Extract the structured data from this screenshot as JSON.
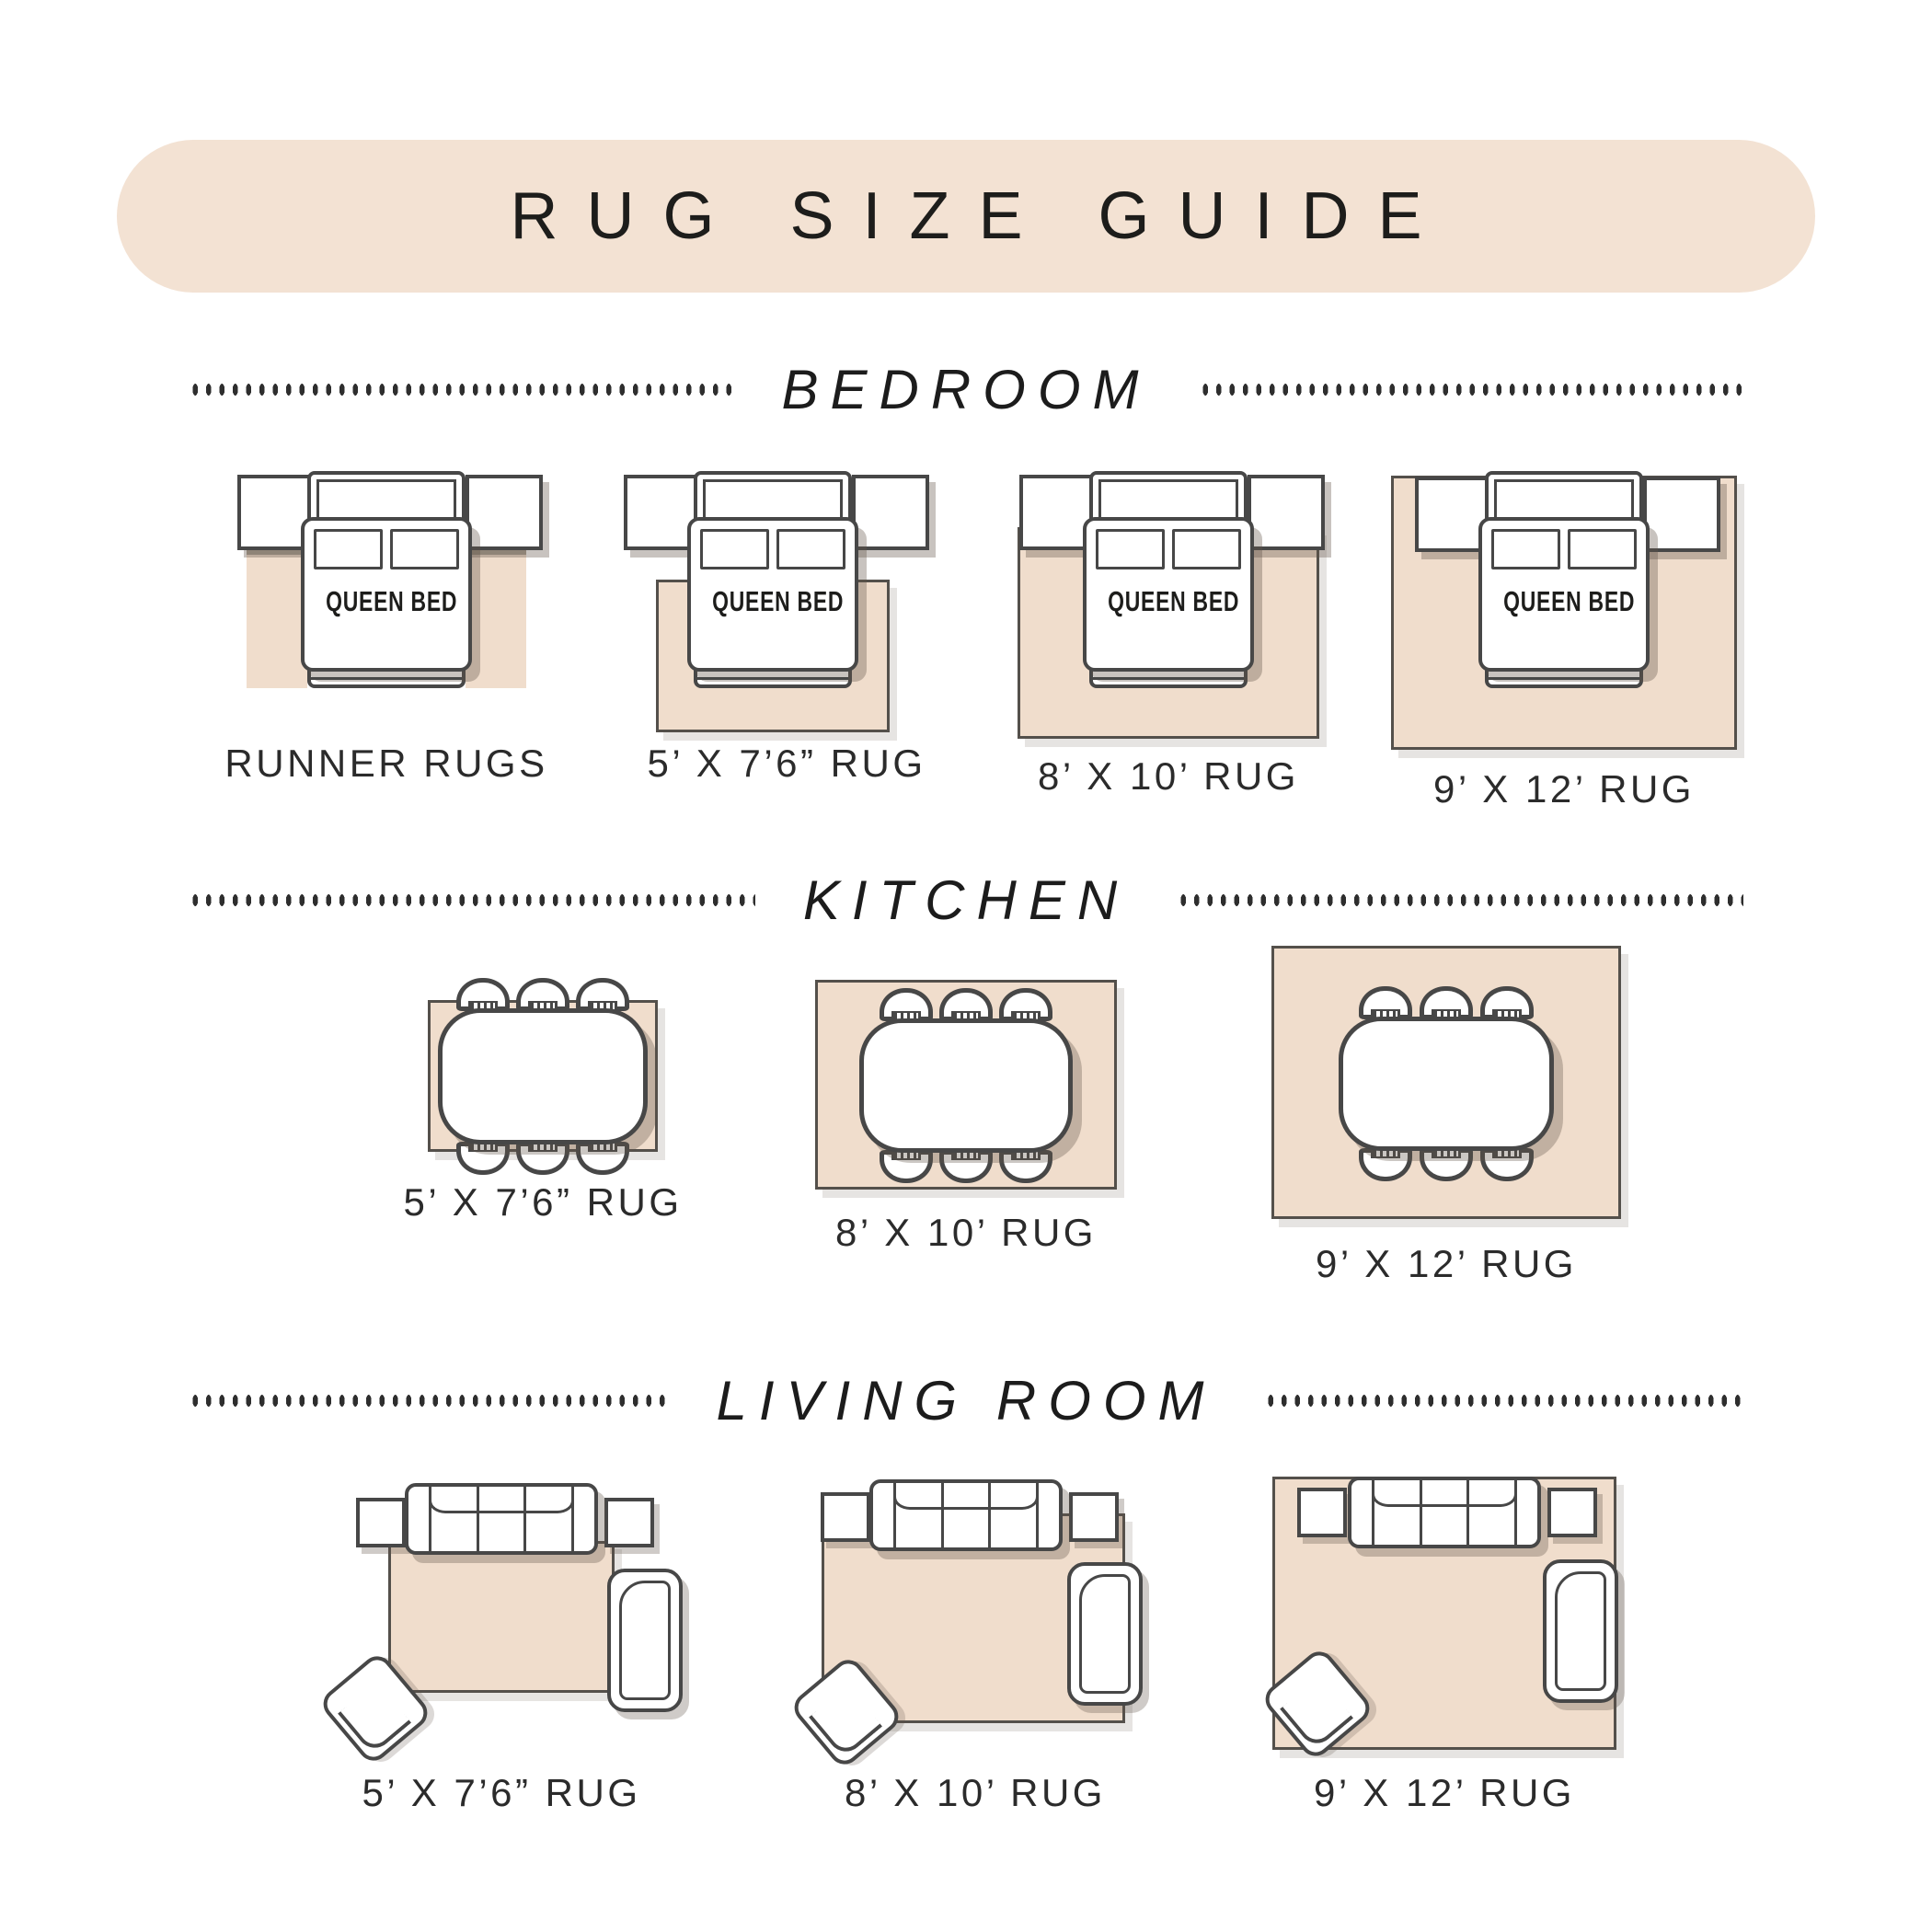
{
  "title": "RUG SIZE GUIDE",
  "labels": {
    "queen_bed": "QUEEN BED"
  },
  "colors": {
    "banner_beige": "#F3E2D3",
    "rug_fill": "#F0DDCC",
    "outline": "#474747",
    "text_dark": "#1D1D1B"
  },
  "sections": {
    "bedroom": {
      "heading": "BEDROOM",
      "rug_labels": [
        "RUNNER RUGS",
        "5’ X 7’6” RUG",
        "8’ X 10’ RUG",
        "9’ X 12’ RUG"
      ]
    },
    "kitchen": {
      "heading": "KITCHEN",
      "rug_labels": [
        "5’ X 7’6” RUG",
        "8’ X 10’ RUG",
        "9’ X 12’ RUG"
      ]
    },
    "living_room": {
      "heading": "LIVING ROOM",
      "rug_labels": [
        "5’ X 7’6” RUG",
        "8’ X 10’ RUG",
        "9’ X 12’ RUG"
      ]
    }
  }
}
